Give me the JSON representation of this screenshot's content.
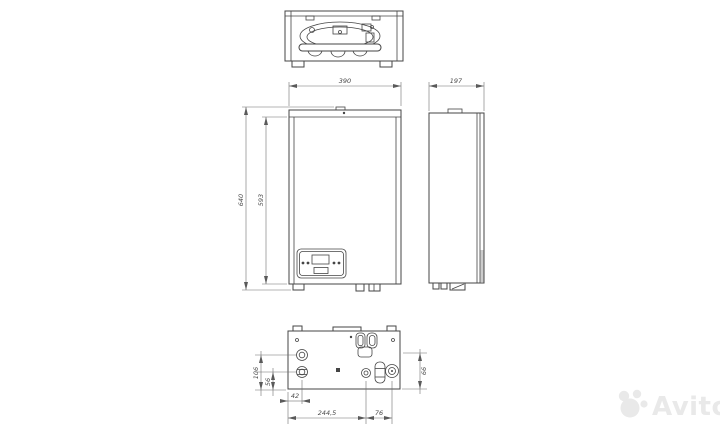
{
  "drawing": {
    "type": "technical-drawing-boiler",
    "line_color": "#454545",
    "dim_line_color": "#6e6e6e",
    "dim_text_color": "#4a4a4a",
    "dimensions": {
      "front_width": "390",
      "side_depth": "197",
      "height_overall": "640",
      "height_body": "593",
      "bottom_left_upper": "106",
      "bottom_left_lower": "56",
      "bottom_offset_left": "42",
      "bottom_span_main": "244,5",
      "bottom_span_right": "76",
      "bottom_right_height": "66"
    }
  },
  "watermark": {
    "label": "Avito",
    "color": "#e9e9e9"
  }
}
